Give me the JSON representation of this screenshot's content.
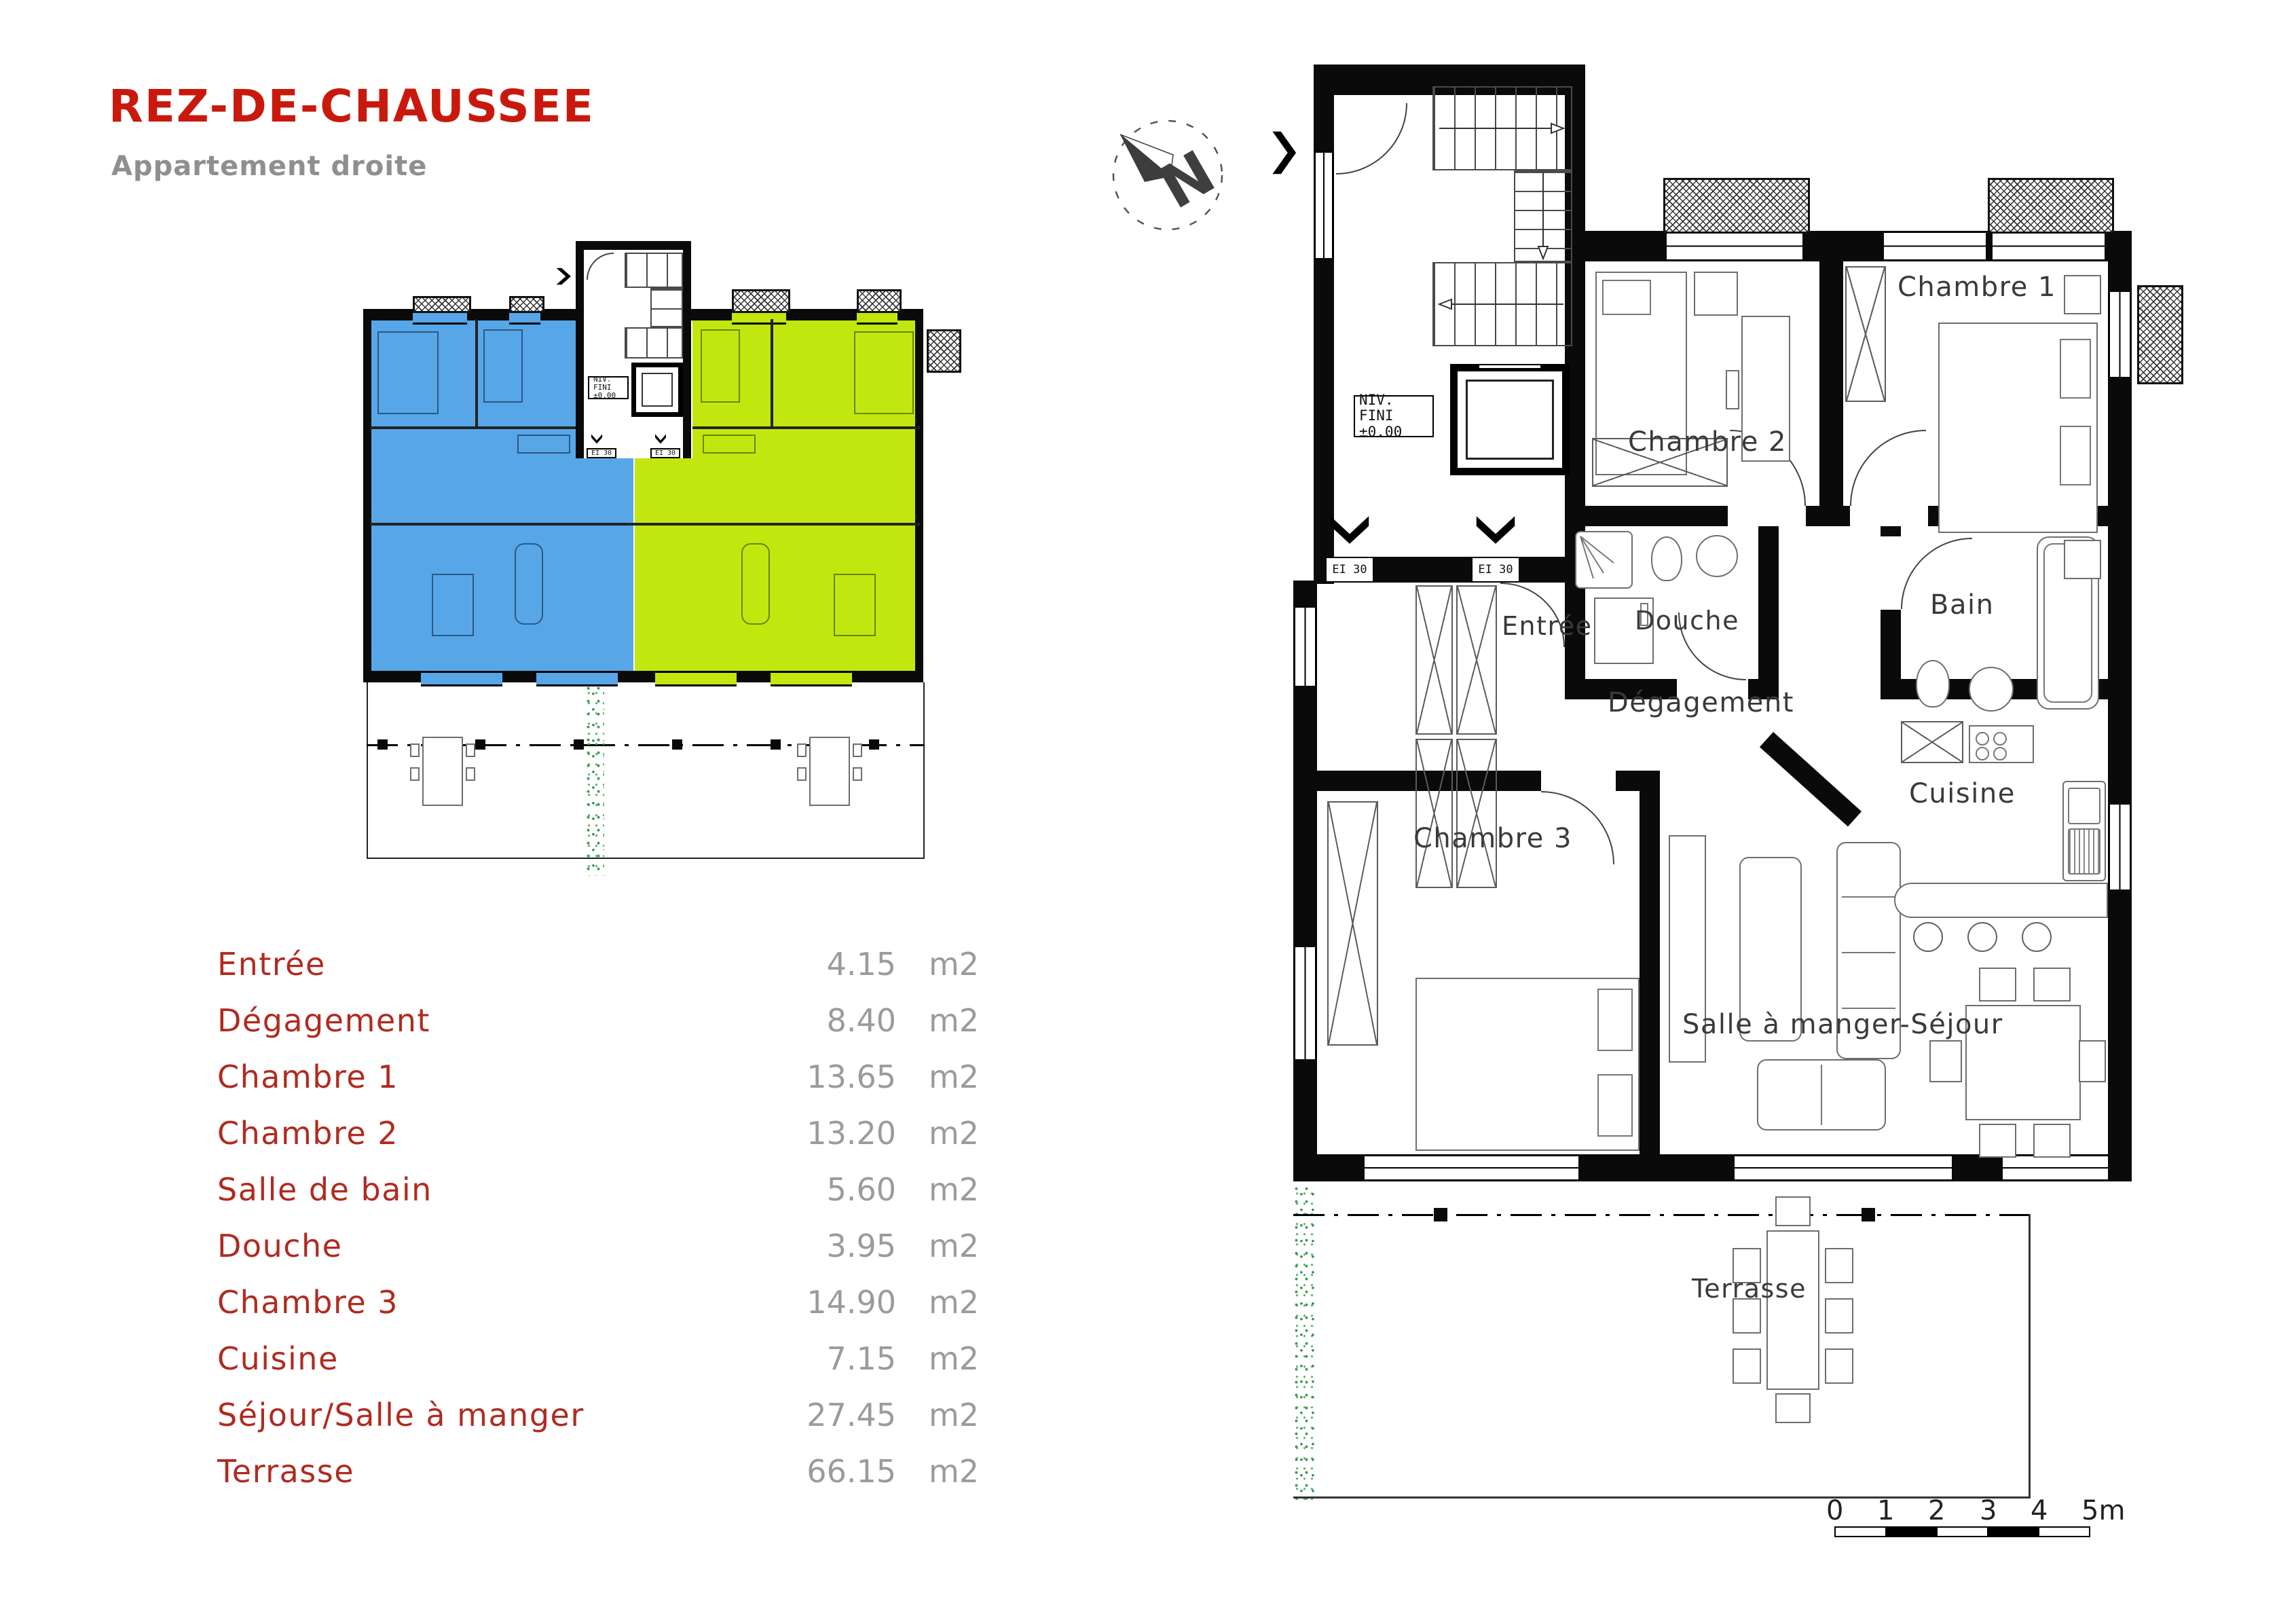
{
  "header": {
    "title": "REZ-DE-CHAUSSEE",
    "subtitle": "Appartement droite"
  },
  "colors": {
    "apartment_left_blue": "#57A7E8",
    "apartment_right_green": "#C2E70F",
    "title_red": "#C9190D",
    "room_label_red": "#B02B20",
    "value_gray": "#9B9B9B",
    "hedge_green": "#3C9B52"
  },
  "area_table": {
    "unit": "m2",
    "rows": [
      {
        "room": "Entrée",
        "area": "4.15"
      },
      {
        "room": "Dégagement",
        "area": "8.40"
      },
      {
        "room": "Chambre 1",
        "area": "13.65"
      },
      {
        "room": "Chambre 2",
        "area": "13.20"
      },
      {
        "room": "Salle de bain",
        "area": "5.60"
      },
      {
        "room": "Douche",
        "area": "3.95"
      },
      {
        "room": "Chambre 3",
        "area": "14.90"
      },
      {
        "room": "Cuisine",
        "area": "7.15"
      },
      {
        "room": "Séjour/Salle à manger",
        "area": "27.45"
      },
      {
        "room": "Terrasse",
        "area": "66.15"
      }
    ]
  },
  "overview_plan": {
    "niv_fini_line1": "NIV. FINI",
    "niv_fini_line2": "±0.00",
    "fire_rating": "EI 30"
  },
  "floor_plan": {
    "niv_fini_line1": "NIV. FINI",
    "niv_fini_line2": "±0.00",
    "fire_rating": "EI 30",
    "rooms": {
      "chambre_1": "Chambre 1",
      "chambre_2": "Chambre 2",
      "chambre_3": "Chambre 3",
      "entree": "Entrée",
      "douche": "Douche",
      "bain": "Bain",
      "degagement": "Dégagement",
      "cuisine": "Cuisine",
      "sejour": "Salle à manger-Séjour",
      "terrasse": "Terrasse"
    }
  },
  "scale_bar": {
    "ticks": [
      "0",
      "1",
      "2",
      "3",
      "4",
      "5m"
    ]
  },
  "icons": {
    "compass": "north-arrow",
    "entry": "entry-arrow"
  }
}
